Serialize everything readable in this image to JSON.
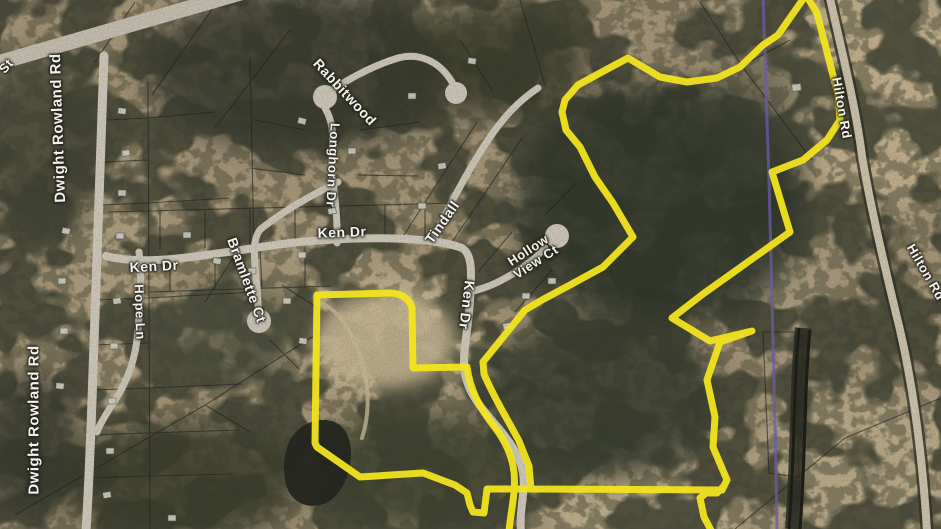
{
  "map": {
    "title": "Aerial parcel map with highlighted property boundary",
    "highlight_color": "#f2e41f",
    "utility_line_color": "#6f5fb5",
    "labels": {
      "st_fragment": "St",
      "dwight_rowland_rd_north": "Dwight Rowland Rd",
      "dwight_rowland_rd_south": "Dwight Rowland Rd",
      "ken_dr_west": "Ken Dr",
      "ken_dr_central": "Ken Dr",
      "ken_dr_south": "Ken Dr",
      "hope_ln": "Hope Ln",
      "longhorn_dr": "Longhorn Dr",
      "rabbitwood": "Rabbitwood",
      "tindall": "Tindall",
      "bramlette_ct": "Bramlette Ct",
      "hollow_view_ct_line1": "Hollow",
      "hollow_view_ct_line2": "View Ct",
      "hilton_rd_north": "Hilton Rd",
      "hilton_rd_east": "Hilton Rd"
    }
  }
}
